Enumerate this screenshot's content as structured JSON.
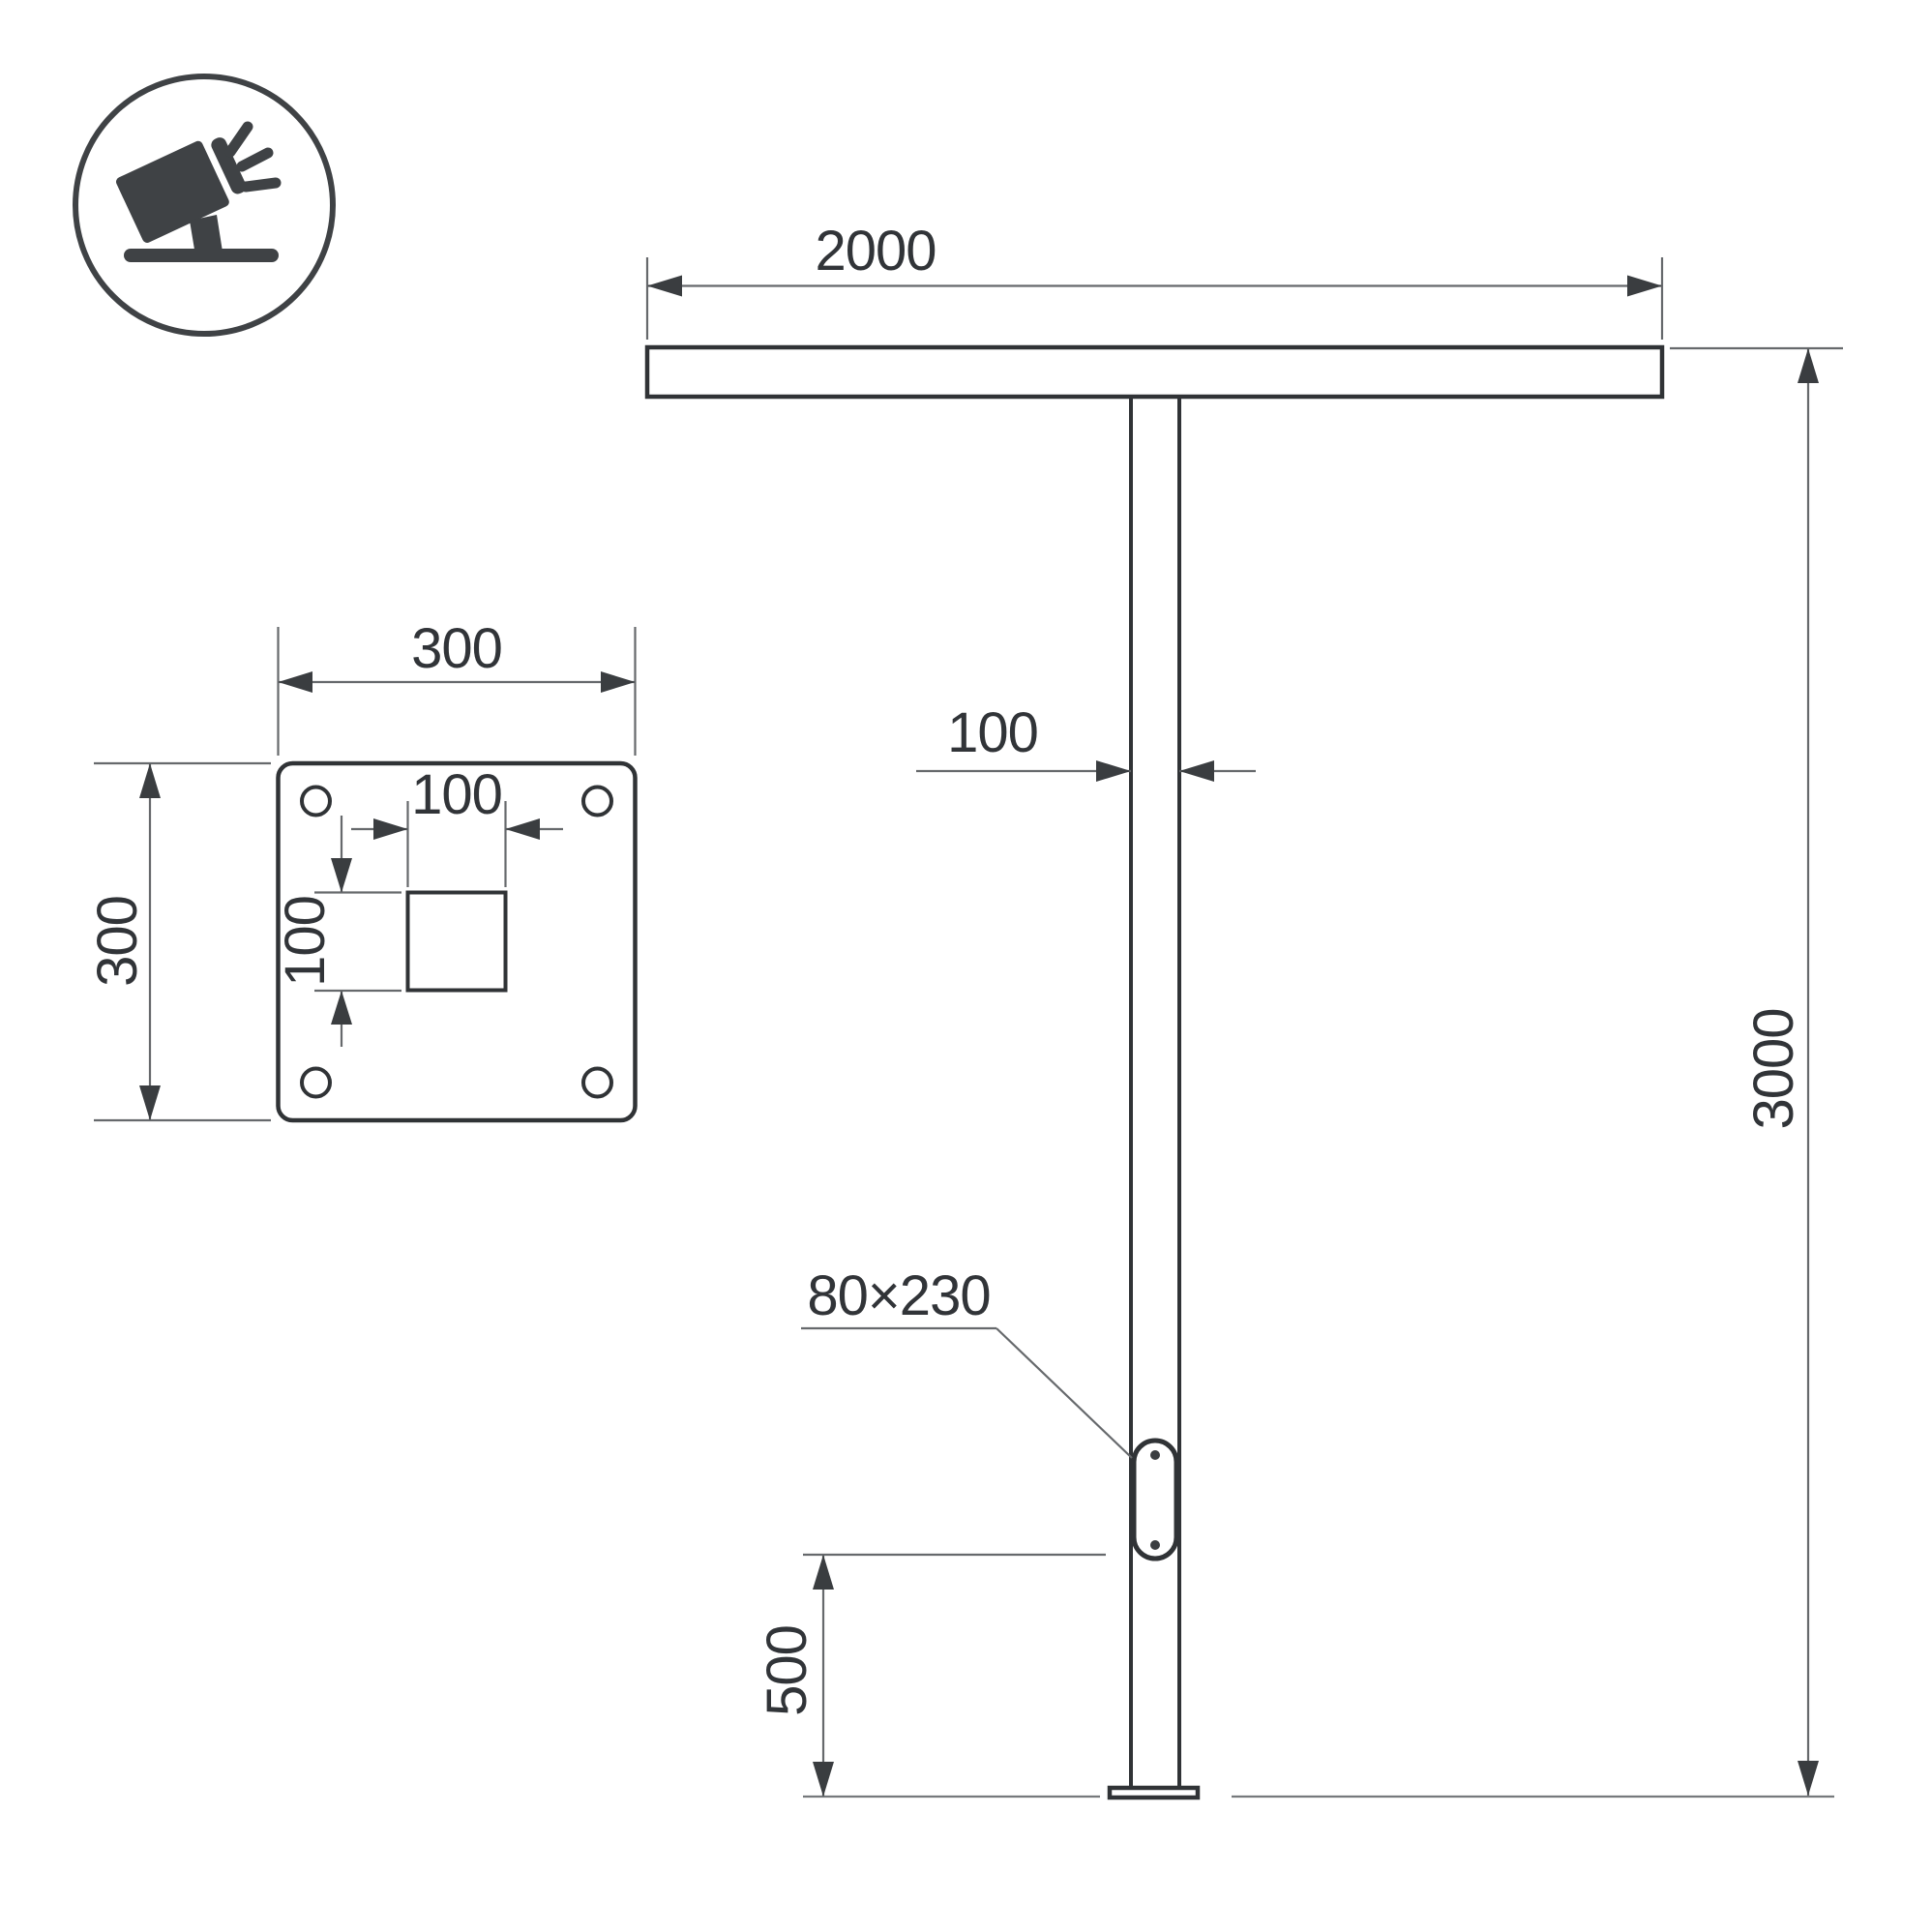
{
  "colors": {
    "background": "#ffffff",
    "outline": "#303336",
    "dimension_line": "#66696c",
    "arrow_and_text": "#35383b"
  },
  "icon": {
    "name": "floodlight-icon"
  },
  "front_view": {
    "crossbar_width": "2000",
    "pole_width": "100",
    "overall_height": "3000",
    "access_door_size": "80×230",
    "access_door_height_above_ground": "500"
  },
  "base_plate": {
    "plate_width": "300",
    "plate_height": "300",
    "cutout_width": "100",
    "cutout_height": "100"
  }
}
